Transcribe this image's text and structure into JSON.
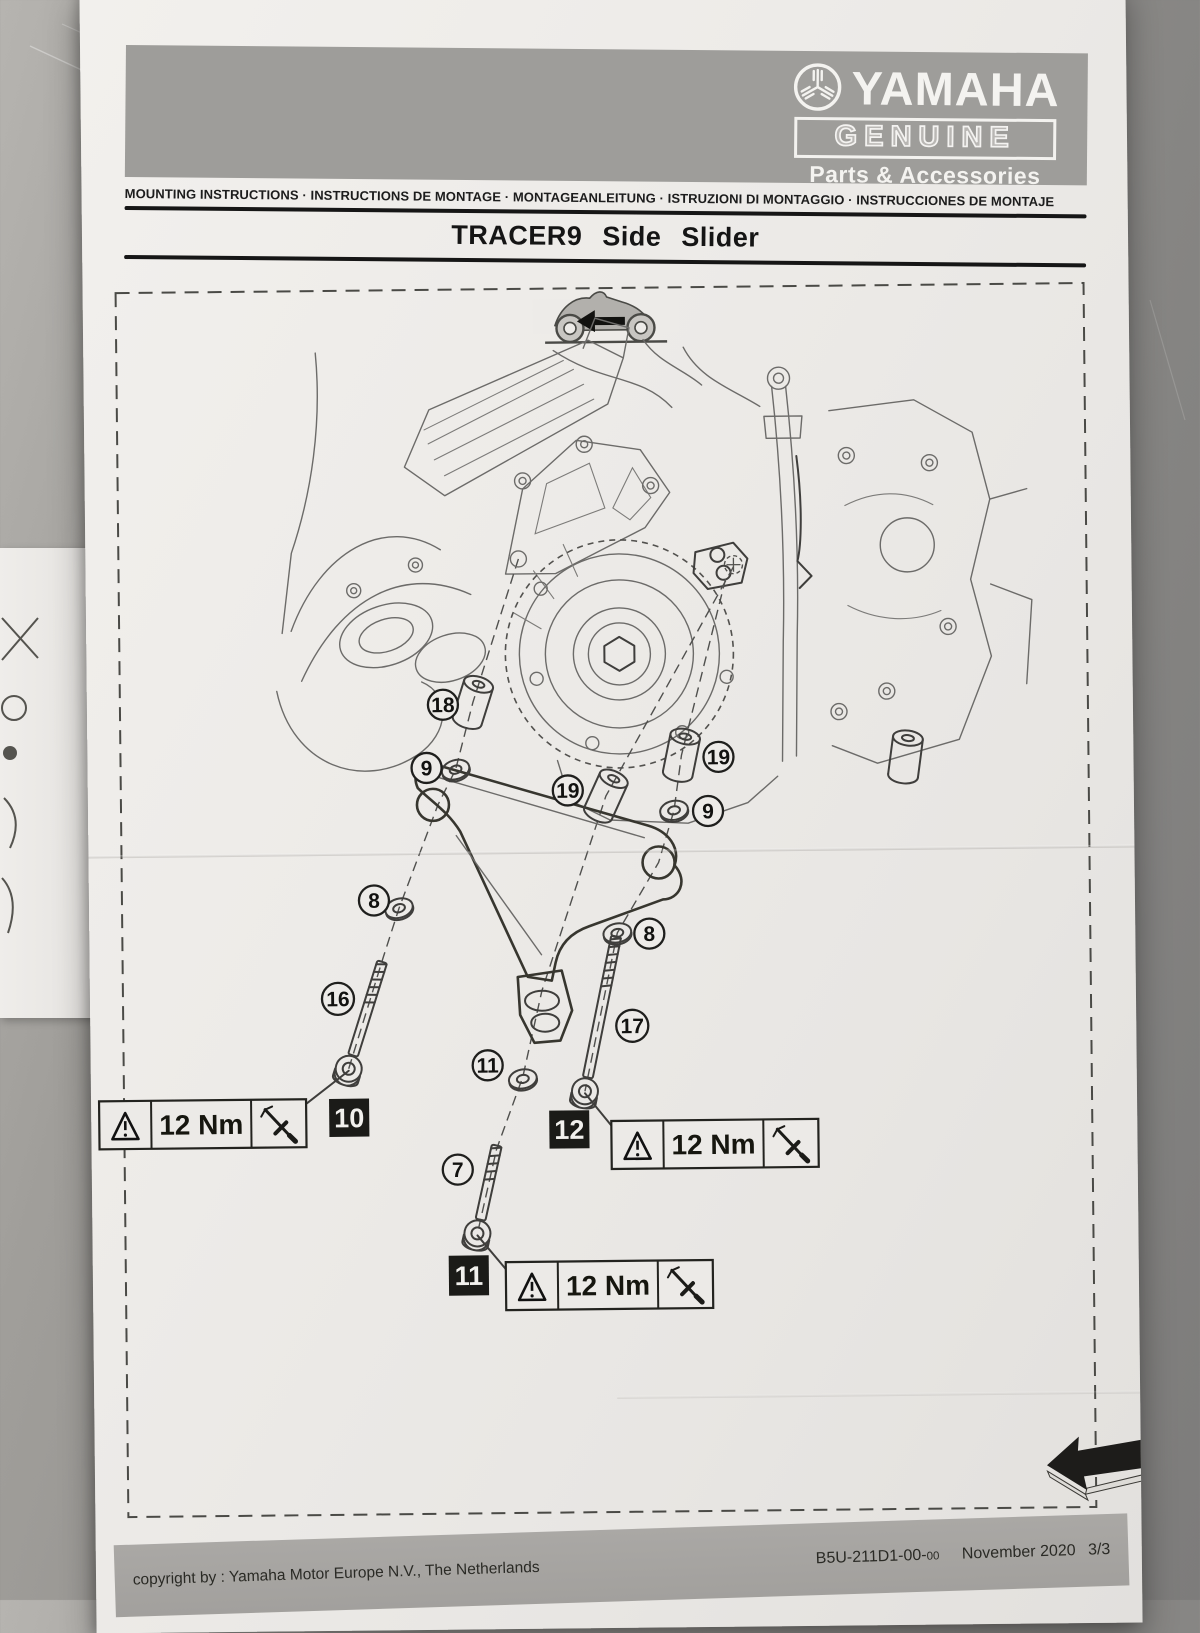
{
  "header": {
    "brand": "YAMAHA",
    "genuine": "GENUINE",
    "parts_accessories": "Parts & Accessories",
    "languages_line": "MOUNTING INSTRUCTIONS · INSTRUCTIONS DE MONTAGE · MONTAGEANLEITUNG · ISTRUZIONI DI MONTAGGIO · INSTRUCCIONES DE MONTAJE"
  },
  "title": "TRACER9 Side Slider",
  "diagram": {
    "callouts": [
      "18",
      "9",
      "19",
      "19",
      "9",
      "8",
      "8",
      "16",
      "17",
      "11",
      "7"
    ],
    "step_boxes": [
      "10",
      "12",
      "11"
    ],
    "torque_labels": [
      "12 Nm",
      "12 Nm",
      "12 Nm"
    ]
  },
  "footer": {
    "copyright": "copyright by :  Yamaha Motor Europe N.V., The Netherlands",
    "part_number": "B5U-211D1-00-",
    "part_number_suffix": "00",
    "date": "November 2020",
    "page": "3/3"
  },
  "colors": {
    "band_gray": "#9e9d9a",
    "footer_gray": "#a5a3a0",
    "paper": "#edebe8",
    "ink": "#1b1b18"
  }
}
